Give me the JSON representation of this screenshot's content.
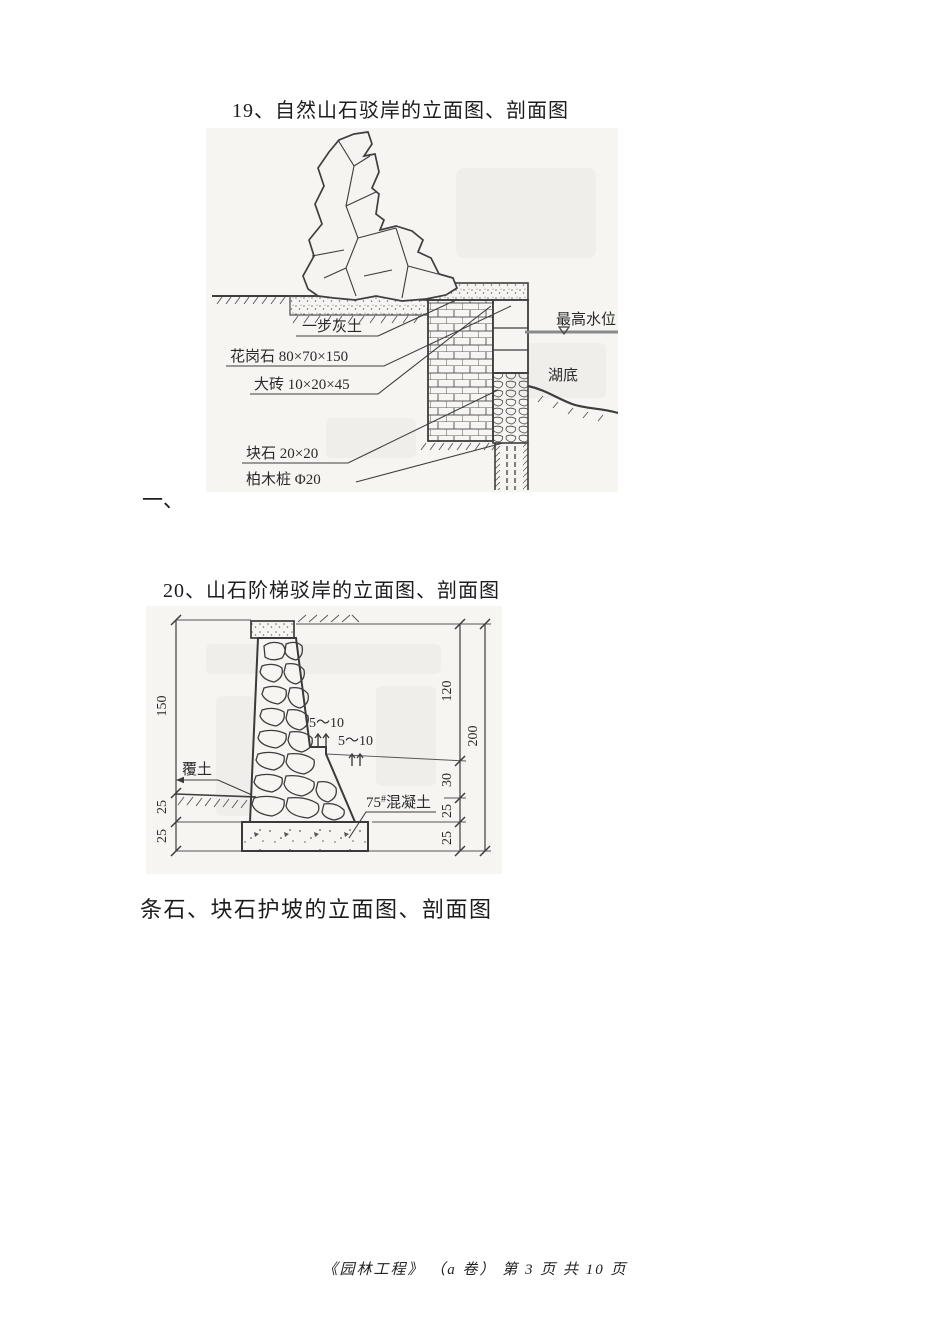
{
  "page": {
    "heading_19": "19、自然山石驳岸的立面图、剖面图",
    "section_marker": "一、",
    "heading_20": "20、山石阶梯驳岸的立面图、剖面图",
    "caption_slope": "条石、块石护坡的立面图、剖面图",
    "footer": "《园林工程》 （a 卷） 第 3 页 共 10 页"
  },
  "figure_19": {
    "labels": {
      "max_water_level": "最高水位",
      "lake_bottom": "湖底",
      "lime_soil": "一步灰土",
      "granite": "花岗石 80×70×150",
      "big_brick": "大砖 10×20×45",
      "block_stone": "块石 20×20",
      "cypress_pile": "柏木桩 Φ20"
    }
  },
  "figure_20": {
    "labels": {
      "cover_soil": "覆土",
      "gap_1": "5～10",
      "gap_2": "5～10",
      "concrete_num": "75",
      "concrete_sup": "#",
      "concrete_name": "混凝土"
    },
    "dims_left": [
      "150",
      "25",
      "25"
    ],
    "dims_right": [
      "120",
      "30",
      "25",
      "25"
    ],
    "dims_total": "200"
  },
  "colors": {
    "ink": "#3d3d3d",
    "scan_bg": "#f6f5f1",
    "water_line": "#8a8a8a"
  }
}
